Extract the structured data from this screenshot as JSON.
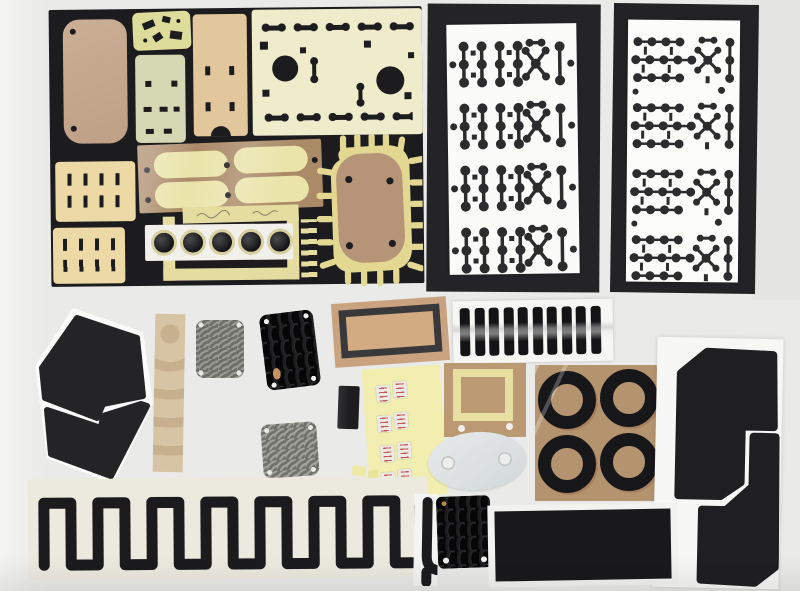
{
  "scene": {
    "description": "Flat-lay photograph of die-cut adhesive gaskets, foam pads, rubber keypads and sealing rings arranged on a white table",
    "background_color": "#eaeae8"
  },
  "colors": {
    "board_black": "#1c1c1f",
    "part_black": "#1b1b1d",
    "cream": "#eeeccb",
    "tan": "#c9ab92",
    "kraft_brown": "#b4946e",
    "pale_yellow": "#f2eeaf",
    "gray_plate": "#9a9a94",
    "white_sheet": "#fbfbfa",
    "backing_white": "#f2f2f0"
  },
  "counts": {
    "dot_sheet_large_rows": 4,
    "dot_sheet_small_rows": 4,
    "glossy_strips": 10,
    "lenses": 5,
    "rings": 4,
    "sticker_pairs": 4,
    "meander_legs": 15,
    "keypad_grid_black": "4x4",
    "keypad_grid_gray_a": "4x4",
    "keypad_grid_gray_b": "5x4"
  },
  "parts": [
    {
      "label": "Black kit board with assorted die-cut foam and paper parts"
    },
    {
      "label": "Tan phone-shaped adhesive pad with two holes"
    },
    {
      "label": "Small yellow pad with angled cutouts"
    },
    {
      "label": "Pale green pad with slot cutouts"
    },
    {
      "label": "Tan pad with slots and半 round bottom notch"
    },
    {
      "label": "Cream plate with two round holes and dot cutout rows"
    },
    {
      "label": "Cream slot pad A"
    },
    {
      "label": "Cream slot pad B"
    },
    {
      "label": "Brown strip with four cream stadium pads under film"
    },
    {
      "label": "Strip of five dark camera lenses with cream rings"
    },
    {
      "label": "Brown blob gasket with spiked yellow border"
    },
    {
      "label": "White sheet with large black dot-cluster cutouts, 4 rows"
    },
    {
      "label": "White sheet with small black dot-cluster cutouts, 4 rows"
    },
    {
      "label": "Black hexagon pad split by white zigzag"
    },
    {
      "label": "Tan backing strip with faint circles"
    },
    {
      "label": "Gray keypad plate with round bumps"
    },
    {
      "label": "Black keypad plate with oblong bumps"
    },
    {
      "label": "Gray keypad plate with five-column bumps"
    },
    {
      "label": "Display gasket frame on kraft backing"
    },
    {
      "label": "Small black block"
    },
    {
      "label": "Yellow sheet with paired white stickers with red print"
    },
    {
      "label": "Panel of ten glossy black strips"
    },
    {
      "label": "Kraft square with cream frame gasket and two holes"
    },
    {
      "label": "Light gray oval plate with two holes"
    },
    {
      "label": "Four black sealing rings on kraft paper in plastic"
    },
    {
      "label": "Two large black angular corner pads on white backing"
    },
    {
      "label": "Long black meander gasket on backing strip"
    },
    {
      "label": "Meander off-cut piece"
    },
    {
      "label": "Small black keypad plate with gold dot"
    },
    {
      "label": "Large black rectangular pad on white backing"
    }
  ],
  "notes": {
    "handwriting": "faint illegible pencil marks on cream strip"
  }
}
